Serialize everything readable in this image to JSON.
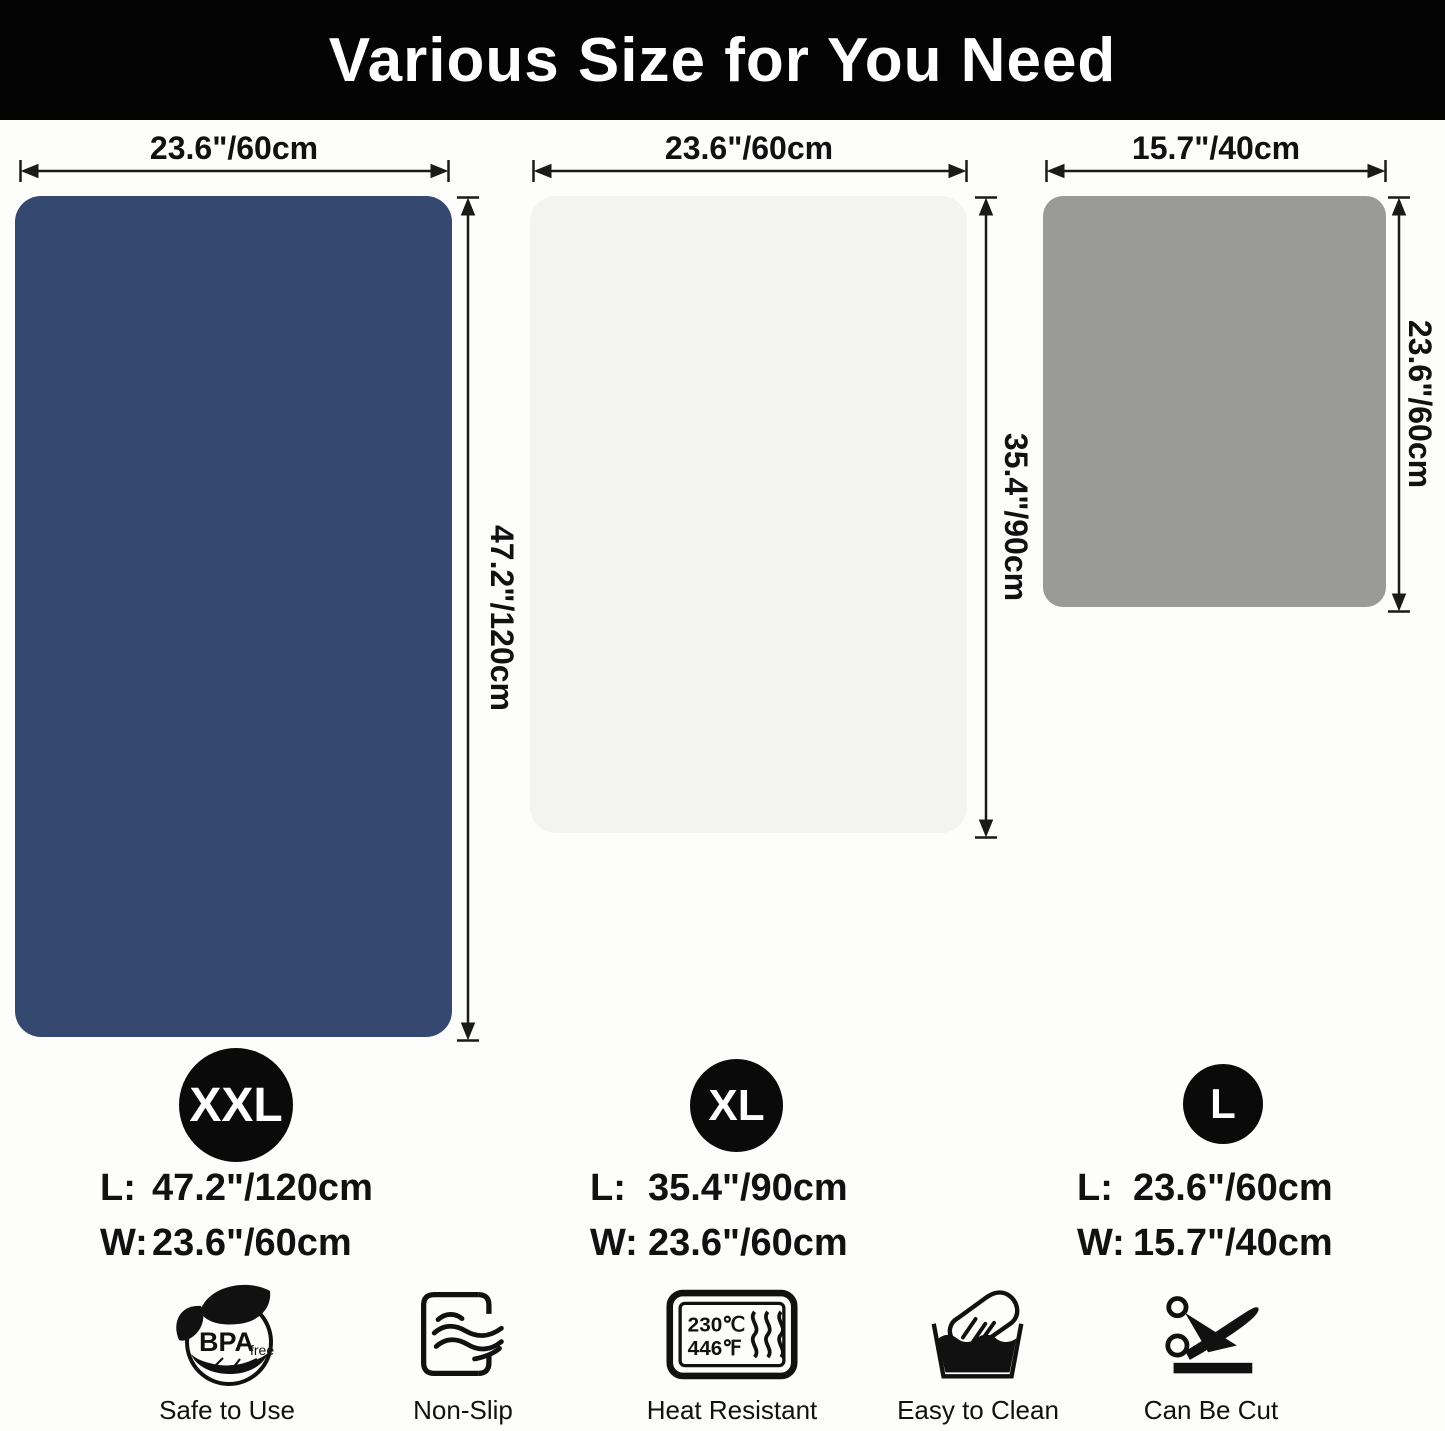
{
  "header": {
    "title": "Various Size for You Need"
  },
  "accent_colors": {
    "mat_xxl": "#35486f",
    "mat_xl": "#f3f3f2",
    "mat_l": "#9a9a98",
    "header_bg": "#040404"
  },
  "mats": [
    {
      "badge": "XXL",
      "width_label": "23.6\"/60cm",
      "height_label": "47.2\"/120cm",
      "specs": [
        {
          "k": "L:",
          "v": "47.2\"/120cm"
        },
        {
          "k": "W:",
          "v": "23.6\"/60cm"
        }
      ],
      "color": "#35486f"
    },
    {
      "badge": "XL",
      "width_label": "23.6\"/60cm",
      "height_label": "35.4\"/90cm",
      "specs": [
        {
          "k": "L:",
          "v": "35.4\"/90cm"
        },
        {
          "k": "W:",
          "v": "23.6\"/60cm"
        }
      ],
      "color": "#f3f3f2"
    },
    {
      "badge": "L",
      "width_label": "15.7\"/40cm",
      "height_label": "23.6\"/60cm",
      "specs": [
        {
          "k": "L:",
          "v": "23.6\"/60cm"
        },
        {
          "k": "W:",
          "v": "15.7\"/40cm"
        }
      ],
      "color": "#9a9a98"
    }
  ],
  "features": [
    {
      "label": "Safe to Use",
      "emblem_text": "BPA",
      "emblem_sub": "free"
    },
    {
      "label": "Non-Slip"
    },
    {
      "label": "Heat Resistant",
      "temp_c": "230℃",
      "temp_f": "446℉"
    },
    {
      "label": "Easy to Clean"
    },
    {
      "label": "Can Be Cut"
    }
  ]
}
